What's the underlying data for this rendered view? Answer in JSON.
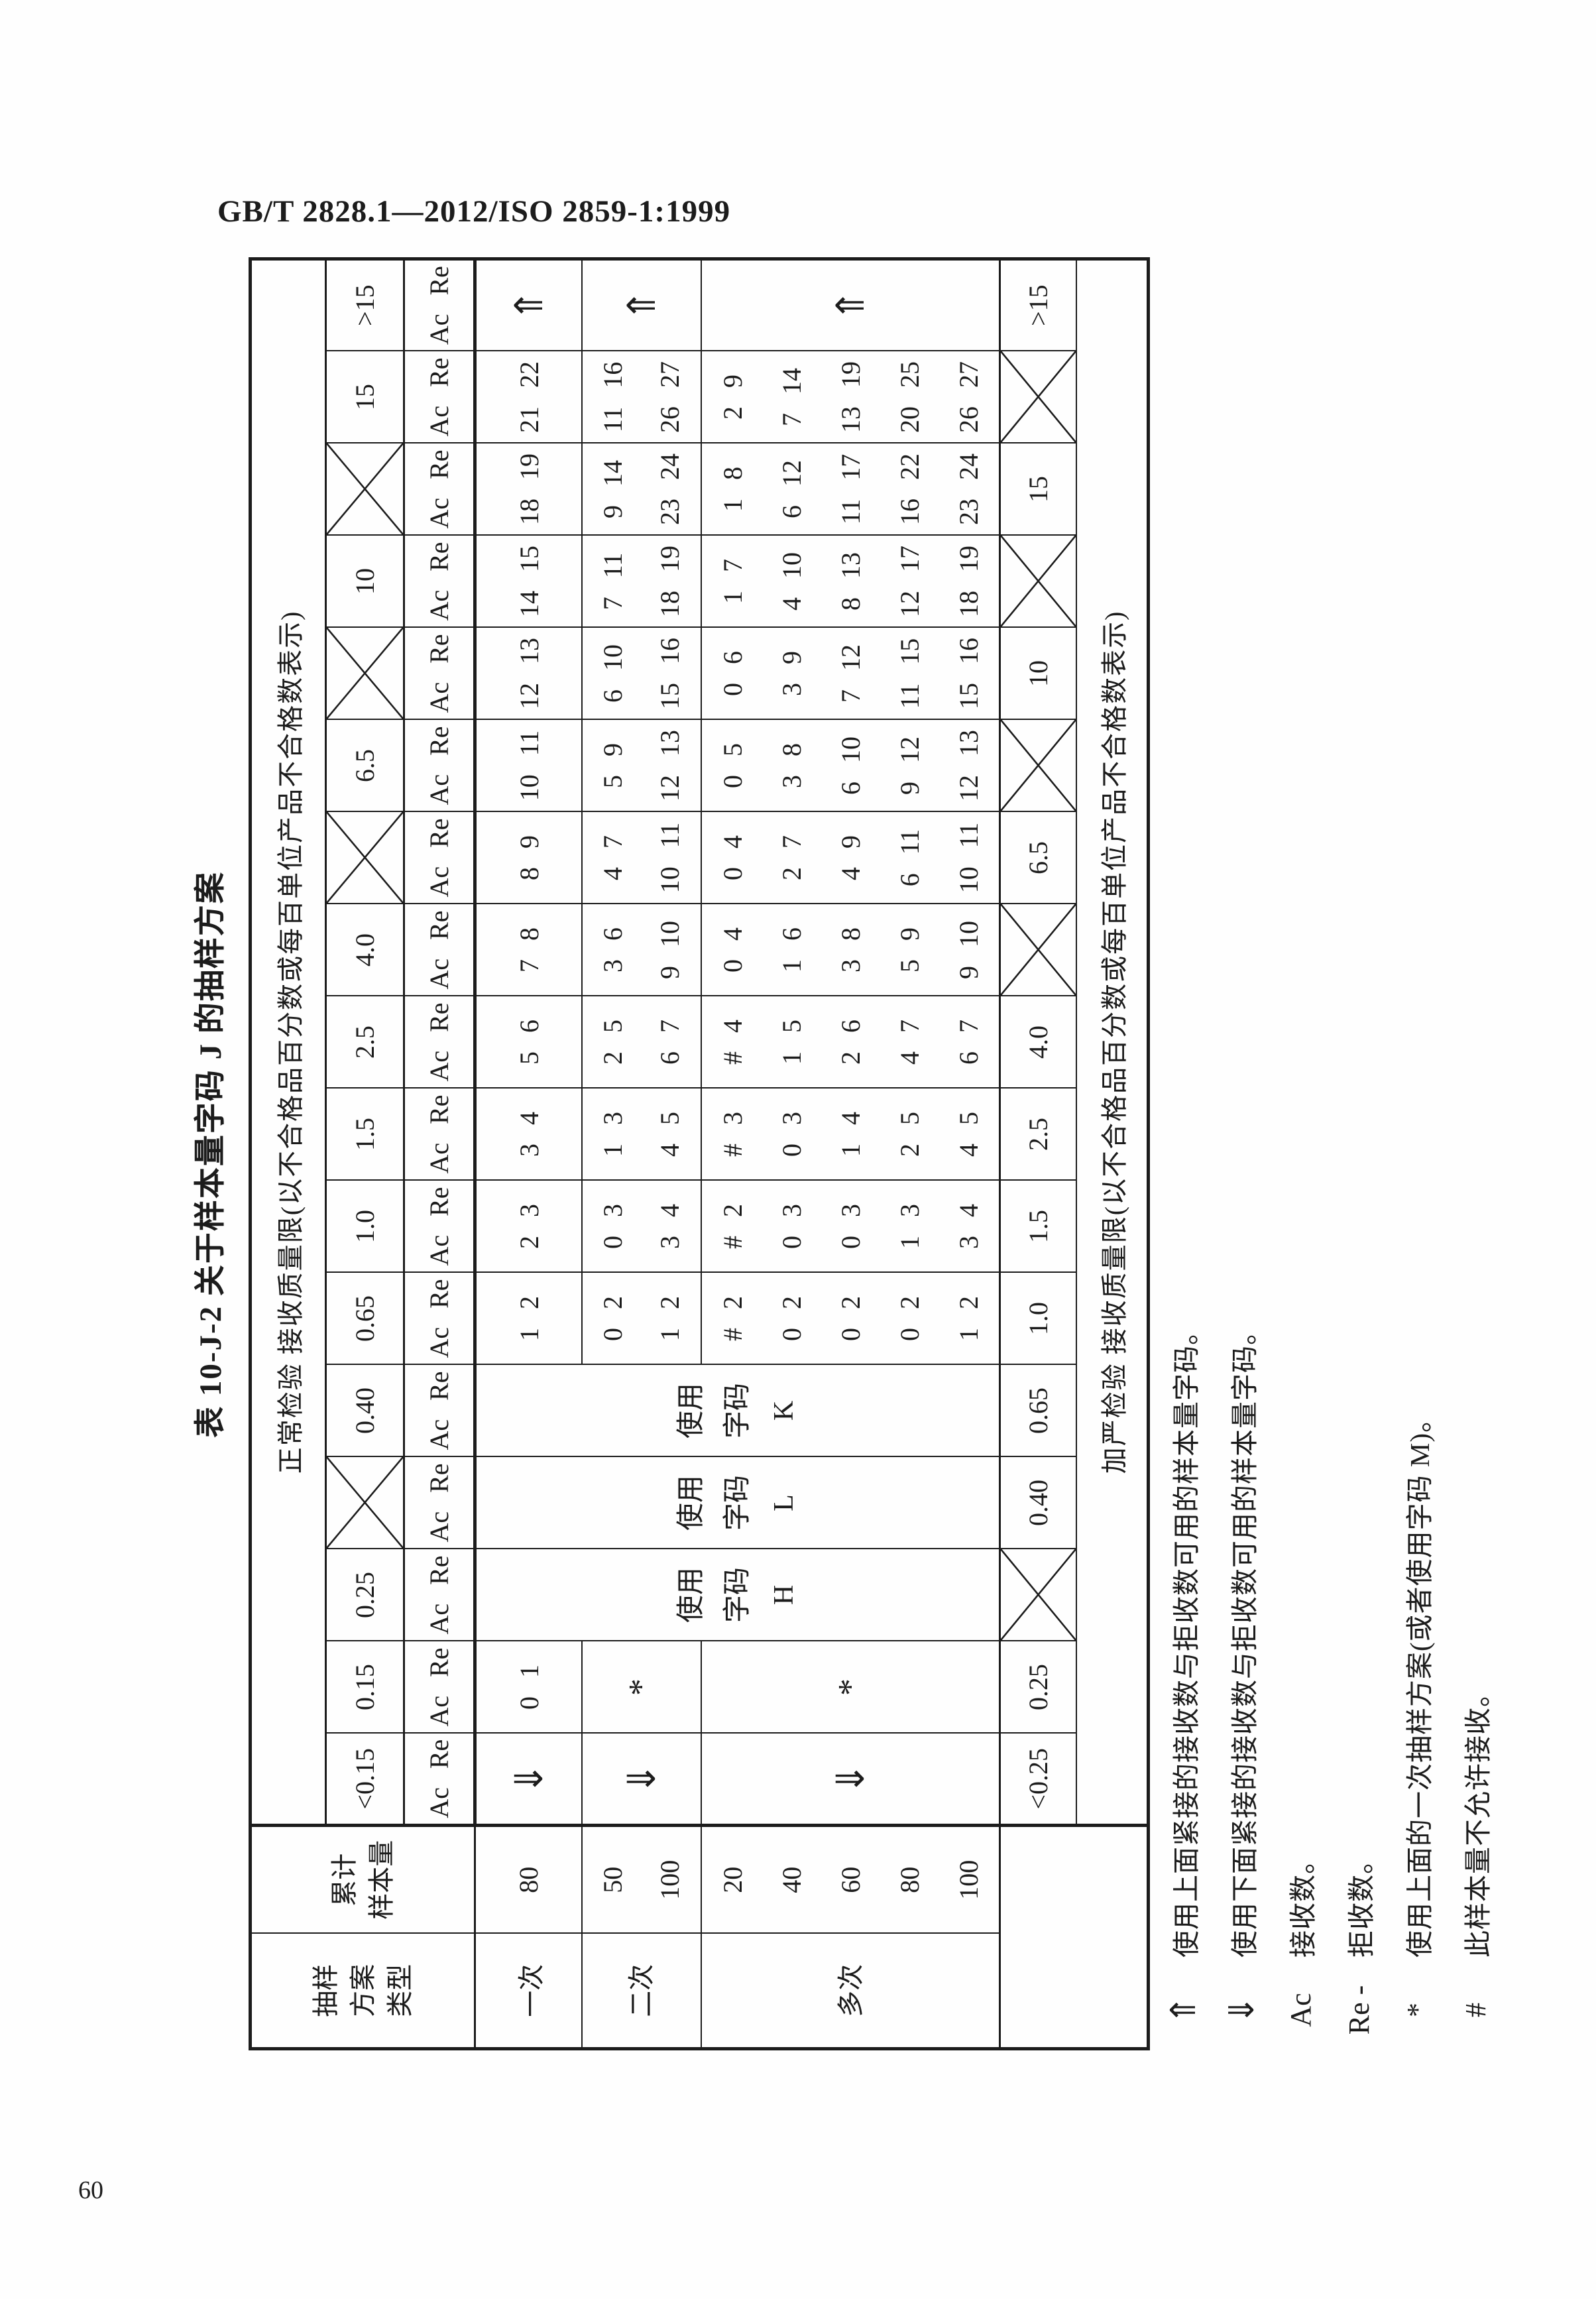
{
  "page": {
    "header": "GB/T 2828.1—2012/ISO 2859-1:1999",
    "number": "60"
  },
  "table": {
    "title": "表 10-J-2  关于样本量字码 J 的抽样方案",
    "normal_header": "正常检验  接收质量限(以不合格品百分数或每百单位产品不合格数表示)",
    "tightened_header": "加严检验  接收质量限(以不合格品百分数或每百单位产品不合格数表示)",
    "col_plan_type_header": "抽样\n方案\n类型",
    "col_cum_size_header": "累计\n样本量",
    "ac_re": "Ac Re",
    "plan_rows": {
      "single": {
        "label": "一次",
        "sizes": "80"
      },
      "double": {
        "label": "二次",
        "sizes": "50\n100"
      },
      "multiple": {
        "label": "多次",
        "sizes": "20\n40\n60\n80\n100"
      }
    },
    "columns": [
      {
        "aql_normal": "<0.15",
        "crossed_normal": false,
        "aql_tightened": "<0.25",
        "crossed_tightened": false,
        "single": "⇓",
        "double": "⇓",
        "multiple": "⇓",
        "use_note": null
      },
      {
        "aql_normal": "0.15",
        "crossed_normal": false,
        "aql_tightened": "0.25",
        "crossed_tightened": false,
        "single": "0 1",
        "double": "*",
        "multiple": "*",
        "use_note": null
      },
      {
        "aql_normal": "0.25",
        "crossed_normal": false,
        "aql_tightened": "",
        "crossed_tightened": true,
        "single": null,
        "double": null,
        "multiple": null,
        "use_note": "使用\n字码\nH"
      },
      {
        "aql_normal": "",
        "crossed_normal": true,
        "aql_tightened": "0.40",
        "crossed_tightened": false,
        "single": null,
        "double": null,
        "multiple": null,
        "use_note": "使用\n字码\nL"
      },
      {
        "aql_normal": "0.40",
        "crossed_normal": false,
        "aql_tightened": "0.65",
        "crossed_tightened": false,
        "single": null,
        "double": null,
        "multiple": null,
        "use_note": "使用\n字码\nK"
      },
      {
        "aql_normal": "0.65",
        "crossed_normal": false,
        "aql_tightened": "1.0",
        "crossed_tightened": false,
        "single": "1 2",
        "double": "0 2\n1 2",
        "multiple": "# 2\n0 2\n0 2\n0 2\n1 2",
        "use_note": null
      },
      {
        "aql_normal": "1.0",
        "crossed_normal": false,
        "aql_tightened": "1.5",
        "crossed_tightened": false,
        "single": "2 3",
        "double": "0 3\n3 4",
        "multiple": "# 2\n0 3\n0 3\n1 3\n3 4",
        "use_note": null
      },
      {
        "aql_normal": "1.5",
        "crossed_normal": false,
        "aql_tightened": "2.5",
        "crossed_tightened": false,
        "single": "3 4",
        "double": "1 3\n4 5",
        "multiple": "# 3\n0 3\n1 4\n2 5\n4 5",
        "use_note": null
      },
      {
        "aql_normal": "2.5",
        "crossed_normal": false,
        "aql_tightened": "4.0",
        "crossed_tightened": false,
        "single": "5 6",
        "double": "2 5\n6 7",
        "multiple": "# 4\n1 5\n2 6\n4 7\n6 7",
        "use_note": null
      },
      {
        "aql_normal": "4.0",
        "crossed_normal": false,
        "aql_tightened": "",
        "crossed_tightened": true,
        "single": "7 8",
        "double": "3 6\n9 10",
        "multiple": "0 4\n1 6\n3 8\n5 9\n9 10",
        "use_note": null
      },
      {
        "aql_normal": "",
        "crossed_normal": true,
        "aql_tightened": "6.5",
        "crossed_tightened": false,
        "single": "8 9",
        "double": "4 7\n10 11",
        "multiple": "0 4\n2 7\n4 9\n6 11\n10 11",
        "use_note": null
      },
      {
        "aql_normal": "6.5",
        "crossed_normal": false,
        "aql_tightened": "",
        "crossed_tightened": true,
        "single": "10 11",
        "double": "5 9\n12 13",
        "multiple": "0 5\n3 8\n6 10\n9 12\n12 13",
        "use_note": null
      },
      {
        "aql_normal": "",
        "crossed_normal": true,
        "aql_tightened": "10",
        "crossed_tightened": false,
        "single": "12 13",
        "double": "6 10\n15 16",
        "multiple": "0 6\n3 9\n7 12\n11 15\n15 16",
        "use_note": null
      },
      {
        "aql_normal": "10",
        "crossed_normal": false,
        "aql_tightened": "",
        "crossed_tightened": true,
        "single": "14 15",
        "double": "7 11\n18 19",
        "multiple": "1 7\n4 10\n8 13\n12 17\n18 19",
        "use_note": null
      },
      {
        "aql_normal": "",
        "crossed_normal": true,
        "aql_tightened": "15",
        "crossed_tightened": false,
        "single": "18 19",
        "double": "9 14\n23 24",
        "multiple": "1 8\n6 12\n11 17\n16 22\n23 24",
        "use_note": null
      },
      {
        "aql_normal": "15",
        "crossed_normal": false,
        "aql_tightened": "",
        "crossed_tightened": true,
        "single": "21 22",
        "double": "11 16\n26 27",
        "multiple": "2 9\n7 14\n13 19\n20 25\n26 27",
        "use_note": null
      },
      {
        "aql_normal": ">15",
        "crossed_normal": false,
        "aql_tightened": ">15",
        "crossed_tightened": false,
        "single": "⇑",
        "double": "⇑",
        "multiple": "⇑",
        "use_note": null
      }
    ]
  },
  "footnotes": [
    {
      "symbol": "⇑",
      "text": "使用上面紧接的接收数与拒收数可用的样本量字码。"
    },
    {
      "symbol": "⇓",
      "text": "使用下面紧接的接收数与拒收数可用的样本量字码。"
    },
    {
      "symbol": "Ac",
      "text": "接收数。"
    },
    {
      "symbol": "Re -",
      "text": "拒收数。"
    },
    {
      "symbol": "*",
      "text": "使用上面的一次抽样方案(或者使用字码 M)。"
    },
    {
      "symbol": "#",
      "text": "此样本量不允许接收。"
    }
  ]
}
